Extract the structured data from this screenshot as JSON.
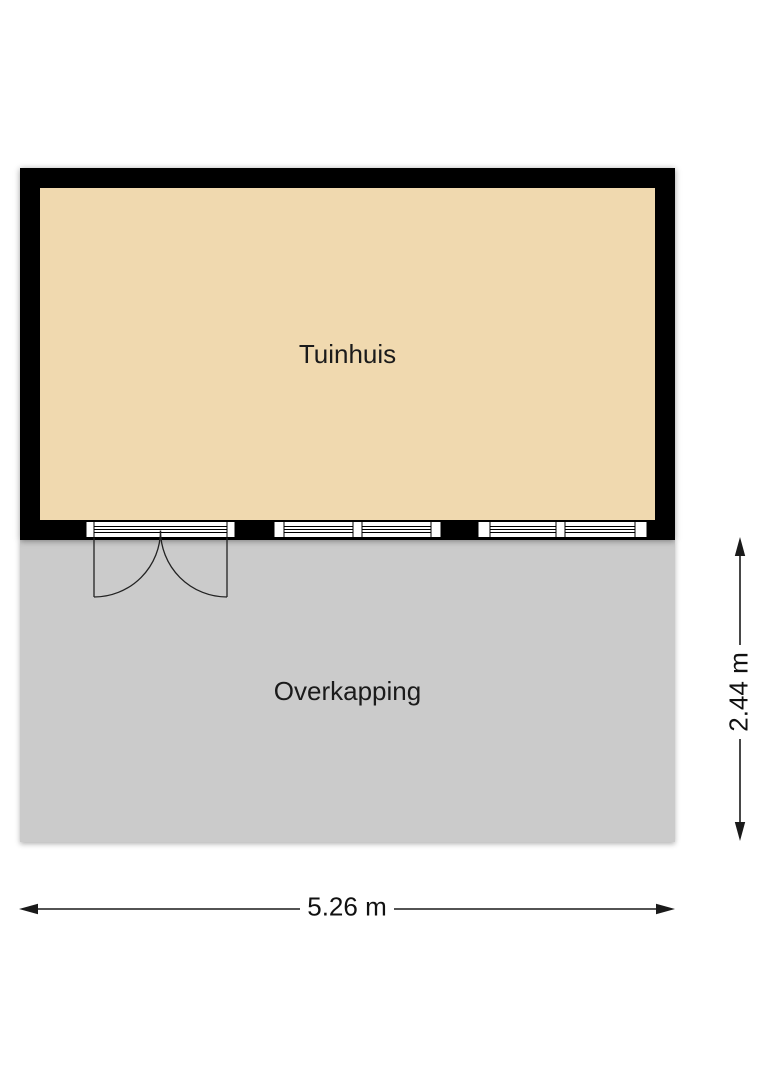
{
  "plan": {
    "rooms": [
      {
        "id": "tuinhuis",
        "label": "Tuinhuis",
        "fill": "#F0D9AF"
      },
      {
        "id": "overkapping",
        "label": "Overkapping",
        "fill": "#CBCBCB"
      }
    ],
    "dimensions": {
      "width": {
        "label": "5.26 m"
      },
      "depth": {
        "label": "2.44 m"
      }
    },
    "features": [
      {
        "id": "double-door",
        "type": "double swing door, opens outward to overkapping"
      },
      {
        "id": "window-1",
        "type": "window, two panes"
      },
      {
        "id": "window-2",
        "type": "window, two panes"
      }
    ],
    "colors": {
      "wall": "#000000",
      "canvas": "#FFFFFF",
      "line": "#1A1A1A"
    }
  }
}
